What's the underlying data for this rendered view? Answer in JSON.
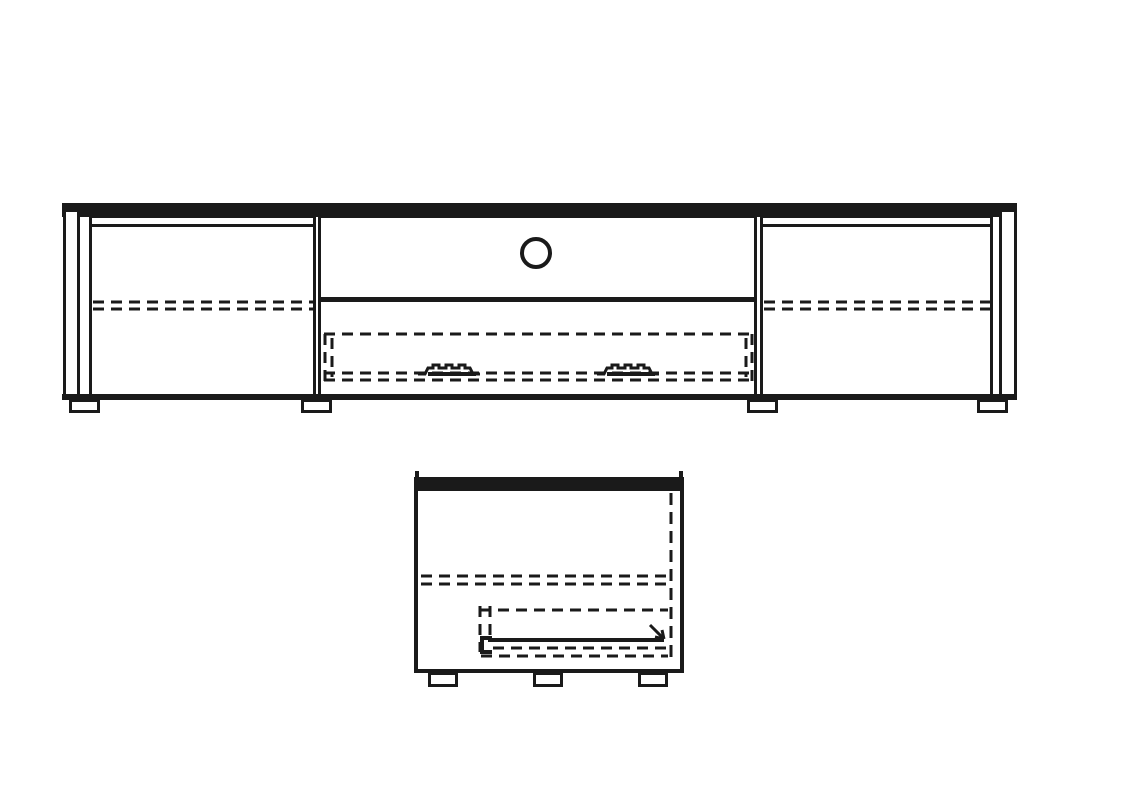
{
  "meta": {
    "type": "technical-drawing",
    "subject": "TV lowboard media cabinet line drawing",
    "views": [
      "front-elevation",
      "side-section"
    ]
  },
  "colors": {
    "background": "#ffffff",
    "line": "#1a1a1a"
  },
  "front_view": {
    "label": "front elevation",
    "parts": [
      {
        "name": "top-panel"
      },
      {
        "name": "left-side-panel"
      },
      {
        "name": "left-door",
        "detail": "hidden shelf shown as double dashed line"
      },
      {
        "name": "open-compartment",
        "detail": "round cable hole in back panel"
      },
      {
        "name": "center-drawer",
        "detail": "hidden drawer box shown dashed with two soft-close runner symbols"
      },
      {
        "name": "right-door",
        "detail": "hidden shelf shown as double dashed line"
      },
      {
        "name": "right-side-panel"
      },
      {
        "name": "bottom-rail"
      },
      {
        "name": "feet",
        "count": 4
      }
    ]
  },
  "side_view": {
    "label": "side section",
    "parts": [
      {
        "name": "top-panel"
      },
      {
        "name": "carcass-side"
      },
      {
        "name": "back-panel",
        "detail": "dashed vertical line"
      },
      {
        "name": "shelf",
        "detail": "double dashed line"
      },
      {
        "name": "drawer",
        "detail": "dashed outline with runner rail and direction arrow"
      },
      {
        "name": "feet",
        "count": 3
      }
    ]
  }
}
